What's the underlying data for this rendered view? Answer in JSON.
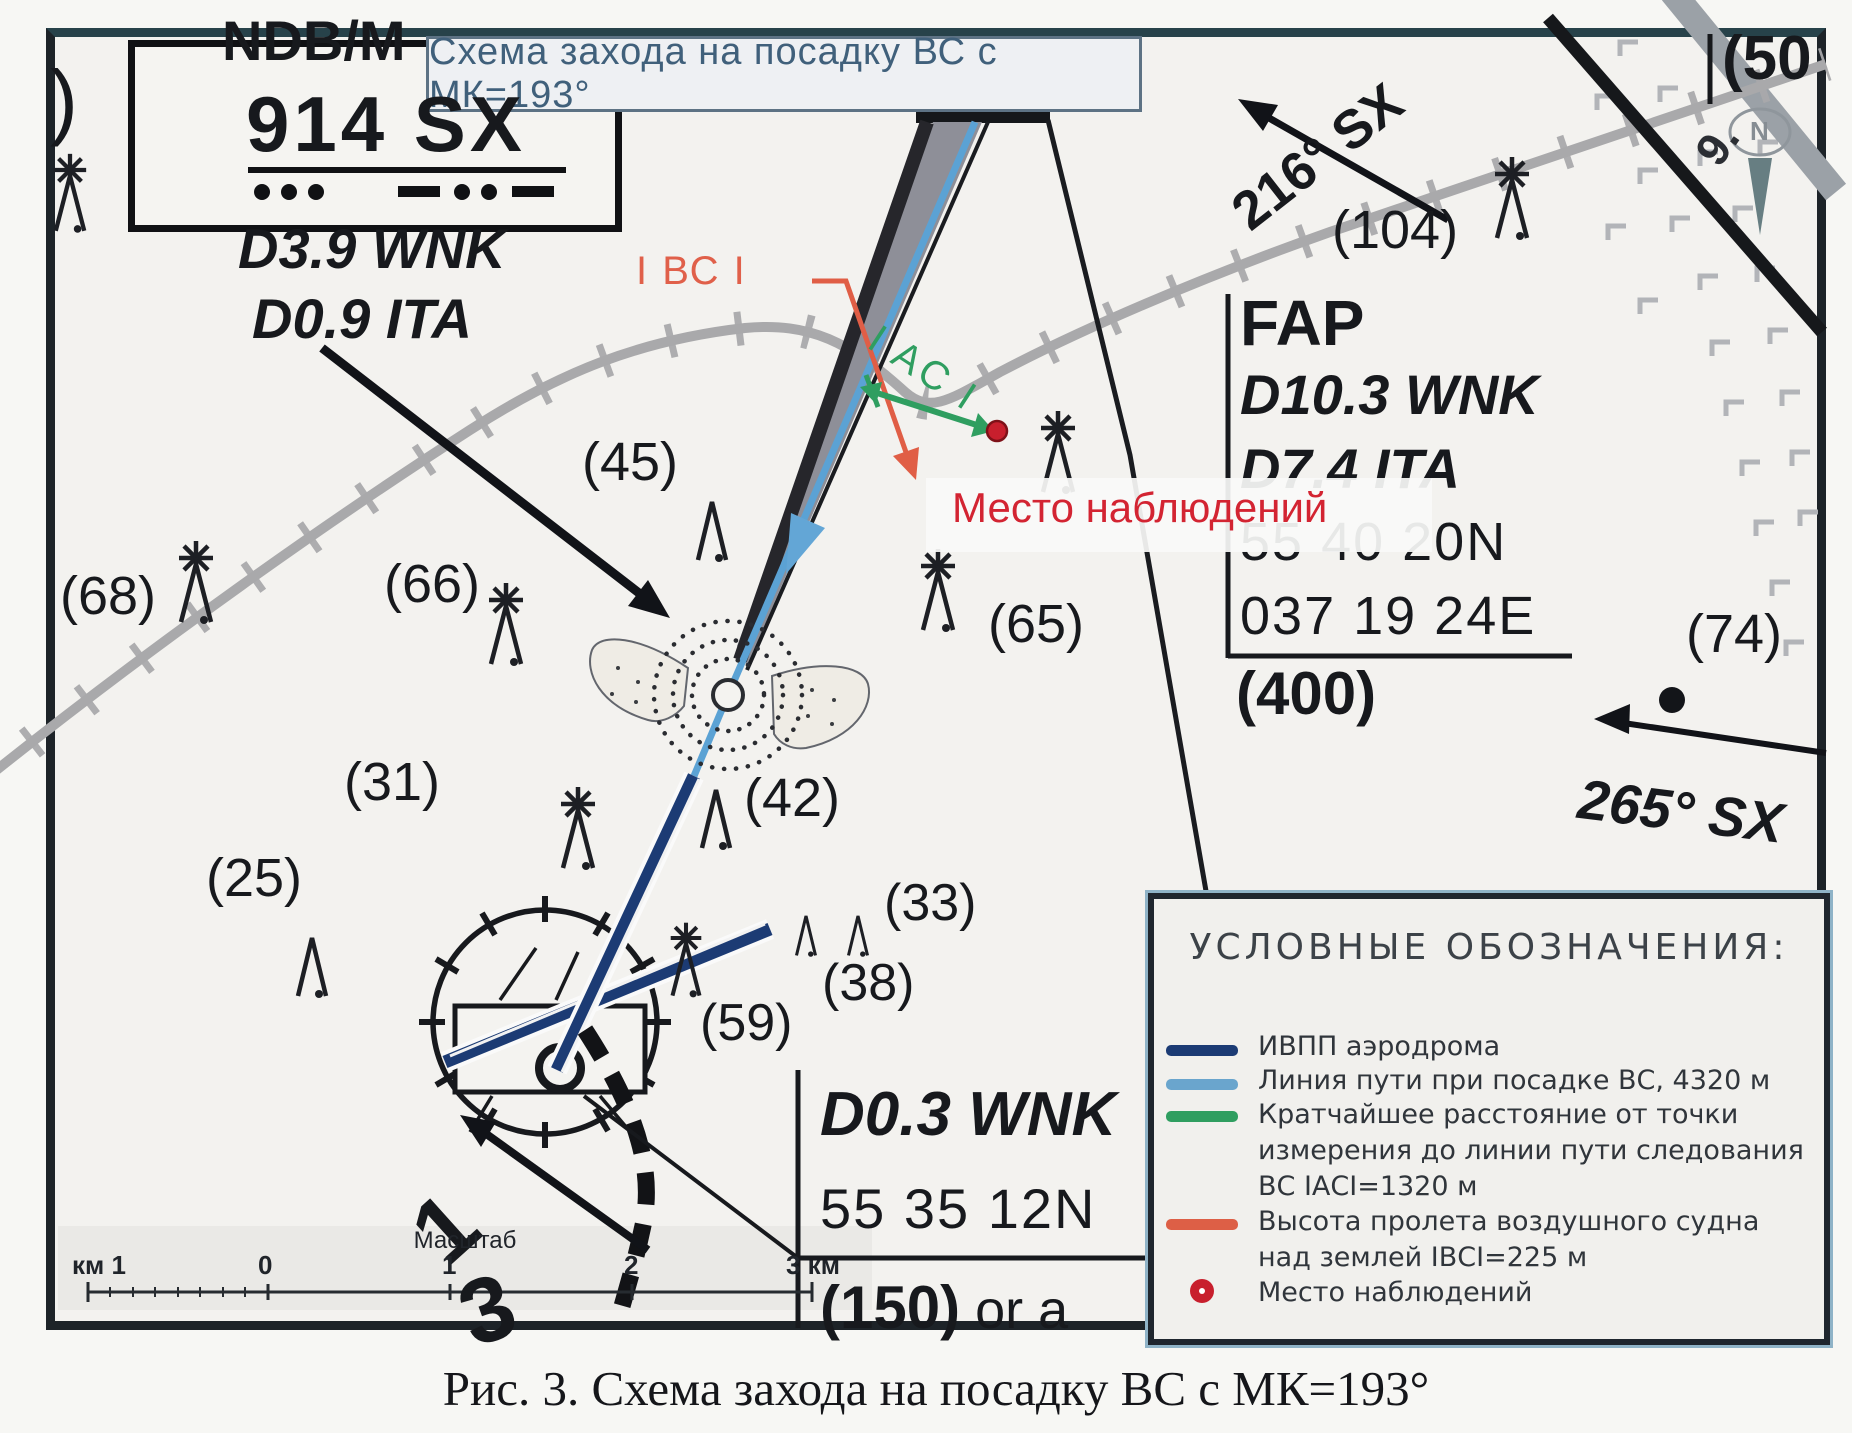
{
  "map": {
    "title_box": "Схема захода на посадку ВС с МК=193°",
    "ndb_box": {
      "title": "NDB/M",
      "ident": "914 SX"
    },
    "approach_labels": {
      "d39": "D3.9 WNK",
      "d09": "D0.9 ITA"
    },
    "fap_box": {
      "title": "FAP",
      "dist1": "D10.3 WNK",
      "dist2": "D7.4 ITA",
      "lat": "55 40 20N",
      "lon": "037 19 24E",
      "elev": "(400)"
    },
    "d03_box": {
      "dist": "D0.3 WNK",
      "lat": "55 35 12N",
      "elev": "(150)",
      "rest": " or a"
    },
    "labels": {
      "bc": "I ВС I",
      "ac": "I AC I",
      "obs": "Место наблюдений",
      "bearing216": "216° SX",
      "bearing265": "265° SX",
      "paren_left": ")",
      "paren50": "(50",
      "rot9": "9.",
      "north": "N",
      "big1": "1",
      "big3": "3"
    },
    "elevations": {
      "e68": "(68)",
      "e45": "(45)",
      "e66": "(66)",
      "e42": "(42)",
      "e65": "(65)",
      "e104": "(104)",
      "e31": "(31)",
      "e25": "(25)",
      "e33": "(33)",
      "e38": "(38)",
      "e59": "(59)",
      "e74": "(74)"
    },
    "scale": {
      "title": "Масштаб",
      "labels": [
        "км 1",
        "0",
        "1",
        "2",
        "3 км"
      ]
    }
  },
  "legend": {
    "title": "УСЛОВНЫЕ ОБОЗНАЧЕНИЯ:",
    "items": [
      {
        "label": "ИВПП аэродрома",
        "color": "#1c3b74",
        "type": "line"
      },
      {
        "label": "Линия пути при посадке ВС, 4320 м",
        "color": "#6aa5cd",
        "type": "line"
      },
      {
        "label": "Кратчайшее расстояние от точки измерения до линии пути следования ВС IАСI=1320 м",
        "color": "#2f9e60",
        "type": "line"
      },
      {
        "label": "Высота пролета воздушного судна над землей IВСI=225 м",
        "color": "#dd5f46",
        "type": "line"
      },
      {
        "label": "Место наблюдений",
        "color": "#c81f2d",
        "type": "dot"
      }
    ]
  },
  "caption": "Рис. 3. Схема захода на посадку ВС с МК=193°"
}
